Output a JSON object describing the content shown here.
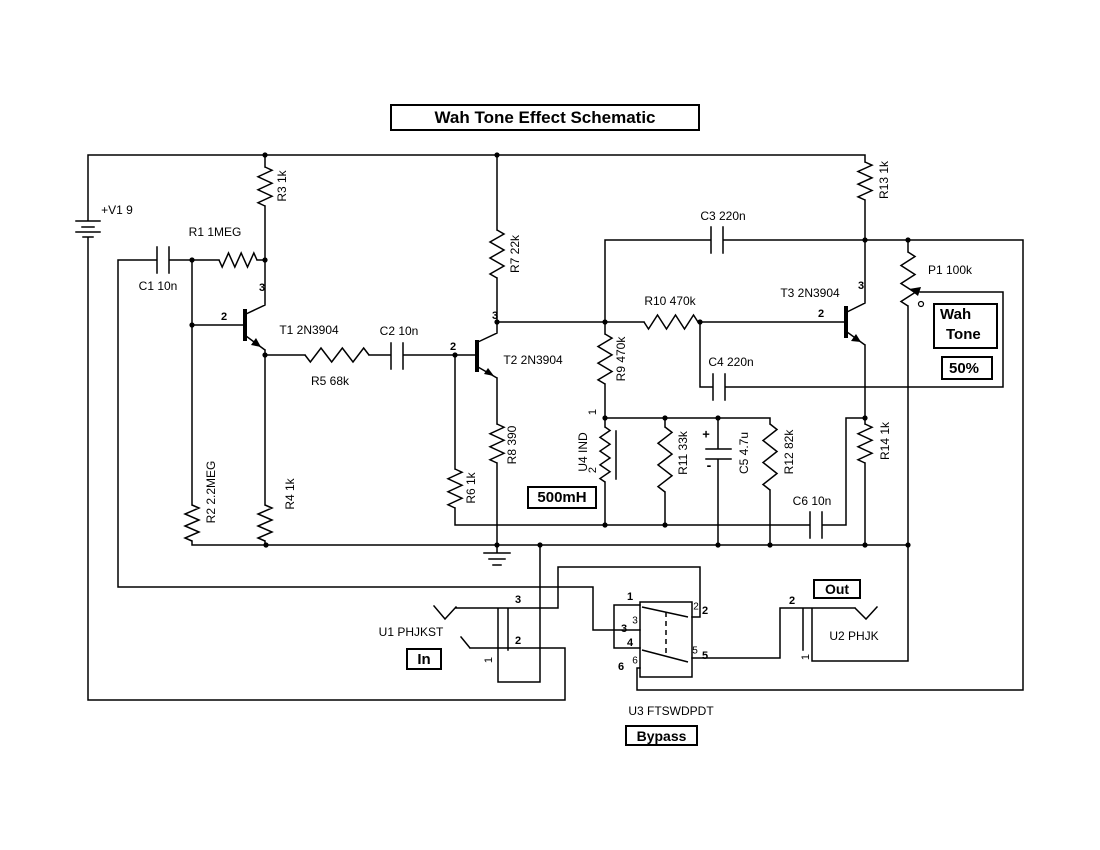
{
  "title": "Wah Tone Effect Schematic",
  "pot_control": {
    "name_line1": "Wah",
    "name_line2": "Tone",
    "position": "50%"
  },
  "inductor_value": "500mH",
  "jack_in_label": "In",
  "jack_out_label": "Out",
  "switch_mode_label": "Bypass",
  "colors": {
    "ink": "#000000",
    "background": "#ffffff"
  },
  "labels": [
    {
      "text": "+V1 9",
      "x": 117,
      "y": 210,
      "name": "label-v1-battery"
    },
    {
      "text": "R1 1MEG",
      "x": 215,
      "y": 232,
      "name": "label-r1"
    },
    {
      "text": "C1 10n",
      "x": 158,
      "y": 286,
      "name": "label-c1"
    },
    {
      "text": "R3 1k",
      "x": 282,
      "y": 186,
      "rot": 1,
      "name": "label-r3"
    },
    {
      "text": "R2 2.2MEG",
      "x": 211,
      "y": 492,
      "rot": 1,
      "name": "label-r2"
    },
    {
      "text": "R4 1k",
      "x": 290,
      "y": 494,
      "rot": 1,
      "name": "label-r4"
    },
    {
      "text": "T1 2N3904",
      "x": 309,
      "y": 330,
      "name": "label-t1"
    },
    {
      "text": "2",
      "x": 224,
      "y": 317,
      "s": 11,
      "b": 1,
      "name": "pin-t1-base"
    },
    {
      "text": "3",
      "x": 262,
      "y": 288,
      "s": 11,
      "b": 1,
      "name": "pin-t1-collector"
    },
    {
      "text": "R5 68k",
      "x": 330,
      "y": 381,
      "name": "label-r5"
    },
    {
      "text": "C2 10n",
      "x": 399,
      "y": 331,
      "name": "label-c2"
    },
    {
      "text": "T2 2N3904",
      "x": 533,
      "y": 360,
      "name": "label-t2"
    },
    {
      "text": "2",
      "x": 453,
      "y": 347,
      "s": 11,
      "b": 1,
      "name": "pin-t2-base"
    },
    {
      "text": "3",
      "x": 495,
      "y": 316,
      "s": 11,
      "b": 1,
      "name": "pin-t2-collector"
    },
    {
      "text": "R6 1k",
      "x": 471,
      "y": 488,
      "rot": 1,
      "name": "label-r6"
    },
    {
      "text": "R8 390",
      "x": 512,
      "y": 445,
      "rot": 1,
      "name": "label-r8"
    },
    {
      "text": "R7 22k",
      "x": 515,
      "y": 254,
      "rot": 1,
      "name": "label-r7"
    },
    {
      "text": "R9 470k",
      "x": 621,
      "y": 359,
      "rot": 1,
      "name": "label-r9"
    },
    {
      "text": "U4 IND",
      "x": 583,
      "y": 452,
      "rot": 1,
      "name": "label-u4"
    },
    {
      "text": "1",
      "x": 593,
      "y": 412,
      "rot": 1,
      "s": 11,
      "name": "pin-u4-1"
    },
    {
      "text": "2",
      "x": 593,
      "y": 470,
      "rot": 1,
      "s": 11,
      "name": "pin-u4-2"
    },
    {
      "text": "R11 33k",
      "x": 683,
      "y": 453,
      "rot": 1,
      "name": "label-r11"
    },
    {
      "text": "C5 4.7u",
      "x": 744,
      "y": 453,
      "rot": 1,
      "name": "label-c5"
    },
    {
      "text": "+",
      "x": 706,
      "y": 434,
      "s": 13,
      "b": 1,
      "name": "c5-plus-sign"
    },
    {
      "text": "-",
      "x": 709,
      "y": 465,
      "s": 14,
      "b": 1,
      "name": "c5-minus-sign"
    },
    {
      "text": "R12 82k",
      "x": 789,
      "y": 452,
      "rot": 1,
      "name": "label-r12"
    },
    {
      "text": "R10 470k",
      "x": 670,
      "y": 301,
      "name": "label-r10"
    },
    {
      "text": "C3 220n",
      "x": 723,
      "y": 216,
      "name": "label-c3"
    },
    {
      "text": "C4 220n",
      "x": 731,
      "y": 362,
      "name": "label-c4"
    },
    {
      "text": "T3 2N3904",
      "x": 810,
      "y": 293,
      "name": "label-t3"
    },
    {
      "text": "2",
      "x": 821,
      "y": 314,
      "s": 11,
      "b": 1,
      "name": "pin-t3-base"
    },
    {
      "text": "3",
      "x": 861,
      "y": 286,
      "s": 11,
      "b": 1,
      "name": "pin-t3-collector"
    },
    {
      "text": "R13 1k",
      "x": 884,
      "y": 180,
      "rot": 1,
      "name": "label-r13"
    },
    {
      "text": "R14 1k",
      "x": 885,
      "y": 441,
      "rot": 1,
      "name": "label-r14"
    },
    {
      "text": "P1 100k",
      "x": 950,
      "y": 270,
      "name": "label-p1"
    },
    {
      "text": "C6 10n",
      "x": 812,
      "y": 501,
      "name": "label-c6"
    },
    {
      "text": "U1 PHJKST",
      "x": 411,
      "y": 632,
      "name": "label-u1"
    },
    {
      "text": "3",
      "x": 518,
      "y": 600,
      "s": 11,
      "b": 1,
      "name": "pin-u1-3"
    },
    {
      "text": "2",
      "x": 518,
      "y": 641,
      "s": 11,
      "b": 1,
      "name": "pin-u1-2"
    },
    {
      "text": "1",
      "x": 489,
      "y": 660,
      "rot": 1,
      "s": 11,
      "name": "pin-u1-1"
    },
    {
      "text": "U2 PHJK",
      "x": 854,
      "y": 636,
      "name": "label-u2"
    },
    {
      "text": "2",
      "x": 792,
      "y": 601,
      "s": 11,
      "b": 1,
      "name": "pin-u2-2"
    },
    {
      "text": "1",
      "x": 806,
      "y": 657,
      "rot": 1,
      "s": 11,
      "name": "pin-u2-1"
    },
    {
      "text": "U3 FTSWDPDT",
      "x": 671,
      "y": 711,
      "name": "label-u3"
    },
    {
      "text": "1",
      "x": 630,
      "y": 597,
      "s": 11,
      "b": 1,
      "name": "pin-u3-1"
    },
    {
      "text": "3",
      "x": 635,
      "y": 621,
      "s": 10,
      "name": "pin-u3-3b"
    },
    {
      "text": "3",
      "x": 624,
      "y": 629,
      "s": 11,
      "b": 1,
      "name": "pin-u3-3"
    },
    {
      "text": "4",
      "x": 630,
      "y": 643,
      "s": 11,
      "b": 1,
      "name": "pin-u3-4"
    },
    {
      "text": "6",
      "x": 635,
      "y": 661,
      "s": 10,
      "name": "pin-u3-6b"
    },
    {
      "text": "6",
      "x": 621,
      "y": 667,
      "s": 11,
      "b": 1,
      "name": "pin-u3-6"
    },
    {
      "text": "2",
      "x": 696,
      "y": 607,
      "s": 10,
      "name": "pin-u3-2b"
    },
    {
      "text": "2",
      "x": 705,
      "y": 611,
      "s": 11,
      "b": 1,
      "name": "pin-u3-2"
    },
    {
      "text": "5",
      "x": 695,
      "y": 651,
      "s": 10,
      "name": "pin-u3-5b"
    },
    {
      "text": "5",
      "x": 705,
      "y": 656,
      "s": 11,
      "b": 1,
      "name": "pin-u3-5"
    }
  ]
}
